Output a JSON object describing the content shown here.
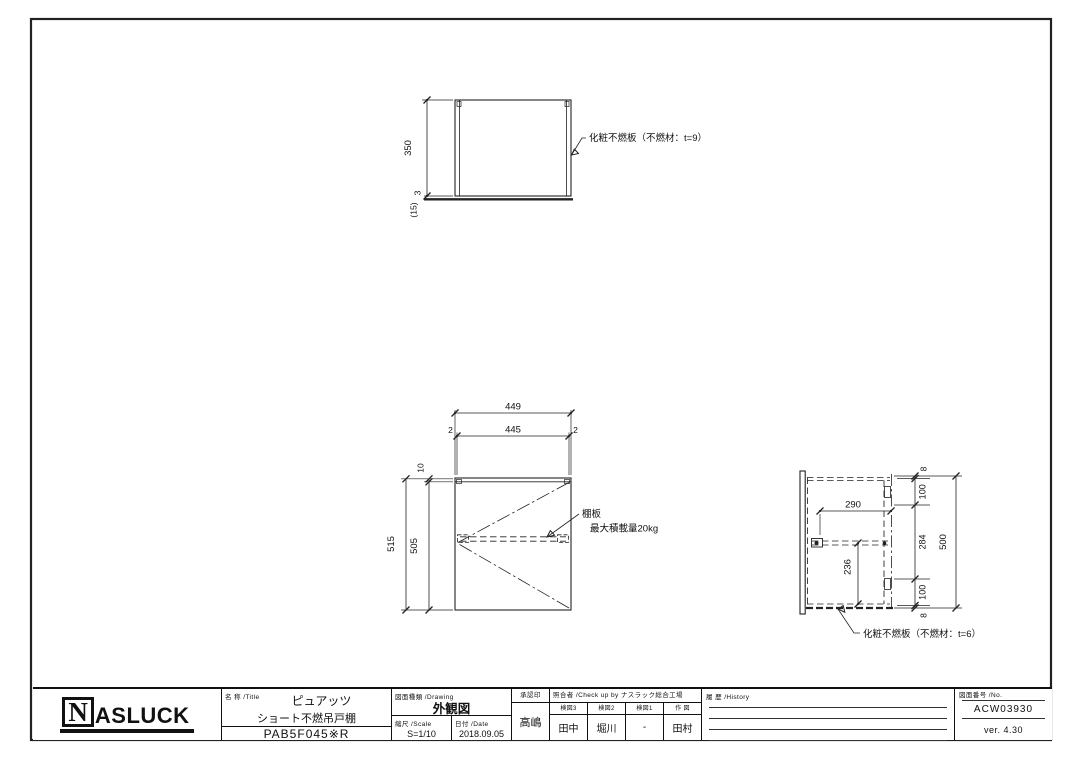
{
  "views": {
    "plan": {
      "dim_height": "350",
      "dim_gap": "3",
      "dim_door": "(15)",
      "panel_label": "化粧不燃板（不燃材：t=9）"
    },
    "front": {
      "dim_outer_w": "449",
      "dim_inner_w": "445",
      "dim_edge_l": "2",
      "dim_edge_r": "2",
      "dim_top": "10",
      "dim_inner_h": "505",
      "dim_outer_h": "515",
      "shelf_name": "棚板",
      "shelf_load": "最大積載量20kg"
    },
    "side": {
      "dim_shelf_w": "290",
      "dim_lower_h": "236",
      "dim_t_top": "8",
      "dim_top_gap": "100",
      "dim_mid": "284",
      "dim_bottom_gap": "100",
      "dim_t_bottom": "8",
      "dim_total": "500",
      "panel_label": "化粧不燃板（不燃材：t=6）"
    }
  },
  "title_block": {
    "logo_n": "N",
    "logo_rest": "ASLUCK",
    "name_label": "名 称 /Title",
    "product_line1": "ピュアッツ",
    "product_line2": "ショート不燃吊戸棚",
    "model": "PAB5F045※R",
    "drawing_label": "図面種類 /Drawing",
    "drawing_type": "外観図",
    "scale_label": "縮尺 /Scale",
    "scale": "S=1/10",
    "date_label": "日付 /Date",
    "date": "2018.09.05",
    "approval_label": "承認印",
    "approver": "高嶋",
    "checkup_label": "照合者 /Check up by ナスラック総合工場",
    "check_cols": [
      {
        "label": "検図3",
        "value": "田中"
      },
      {
        "label": "検図2",
        "value": "堀川"
      },
      {
        "label": "検図1",
        "value": "-"
      },
      {
        "label": "作 図",
        "value": "田村"
      }
    ],
    "history_label": "履 歴 /History",
    "number_label": "図面番号 /No.",
    "drawing_number": "ACW03930",
    "version": "ver. 4.30"
  }
}
